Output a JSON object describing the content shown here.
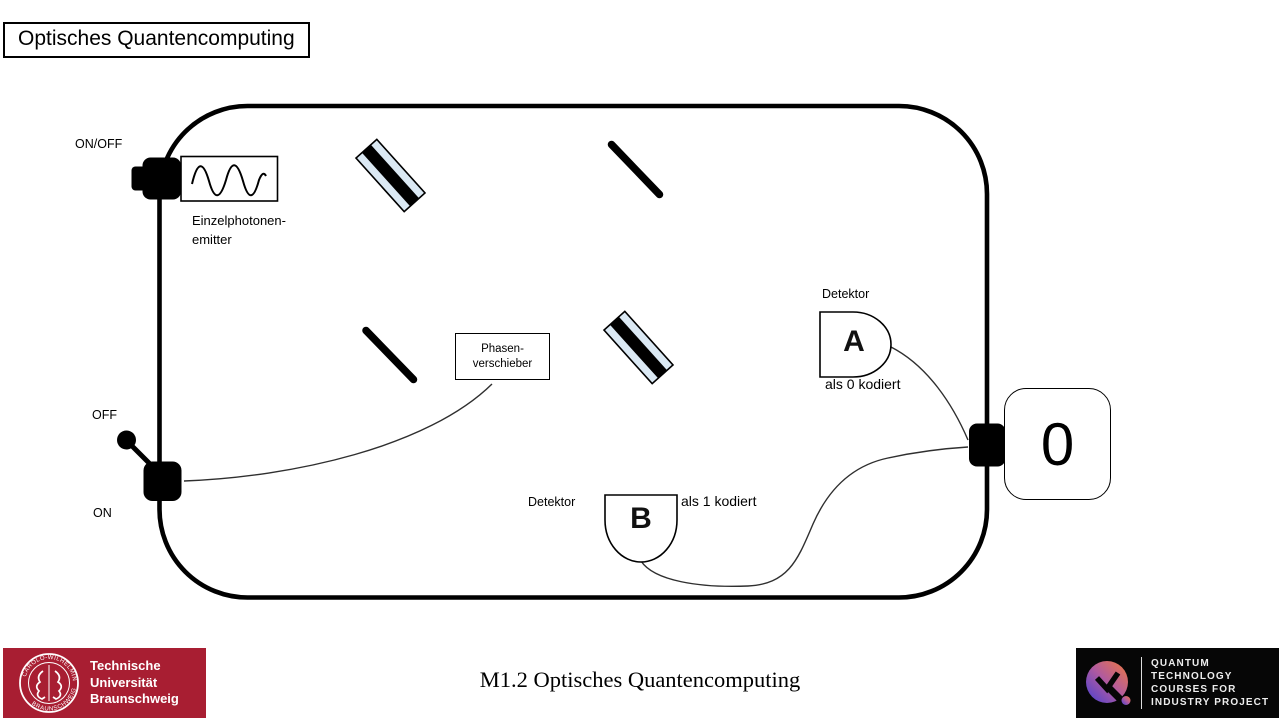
{
  "slide": {
    "title": "Optisches Quantencomputing",
    "footer_caption": "M1.2 Optisches Quantencomputing"
  },
  "diagram": {
    "source": {
      "switch_label": "ON/OFF",
      "name_line1": "Einzelphotonen-",
      "name_line2": "emitter"
    },
    "power_switch": {
      "off_label": "OFF",
      "on_label": "ON"
    },
    "phase_shifter": {
      "line1": "Phasen-",
      "line2": "verschieber"
    },
    "detector_a": {
      "title": "Detektor",
      "letter": "A",
      "coding": "als 0 kodiert"
    },
    "detector_b": {
      "title": "Detektor",
      "letter": "B",
      "coding": "als 1 kodiert"
    },
    "output": {
      "value": "0"
    },
    "colors": {
      "outline": "#000000",
      "thin_line": "#2f2f2f",
      "beamsplitter_fill": "#dbe9f4"
    }
  },
  "logos": {
    "tu_braunschweig": {
      "bg_color": "#a81e32",
      "line1": "Technische",
      "line2": "Universität",
      "line3": "Braunschweig",
      "seal_top": "CAROLO-WILHELMINA",
      "seal_bottom": "BRAUNSCHWEIG"
    },
    "qtcip": {
      "bg_color": "#060606",
      "gradient": [
        "#f0793e",
        "#b05aa0",
        "#4740d4"
      ],
      "line1": "QUANTUM",
      "line2": "TECHNOLOGY",
      "line3": "COURSES FOR",
      "line4": "INDUSTRY PROJECT"
    }
  }
}
